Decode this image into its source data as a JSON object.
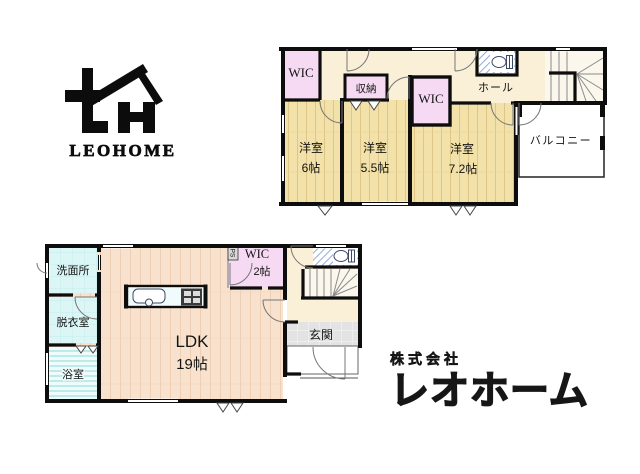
{
  "palette": {
    "wall": "#0d0d0d",
    "room_yellow": "#F2E1A8",
    "room_yellow_line": "#DEC687",
    "closet_pink": "#F6D9F2",
    "hall_cream": "#FAF0D8",
    "stair_white": "#FCF7ED",
    "ldk_peach": "#F8E2CE",
    "ldk_line": "#EDCFB6",
    "wet_cyan": "#DCF6F6",
    "bath_stripe": "#A8E2E2",
    "entrance_gray": "#E3E3E3",
    "hatch_blue": "#93A9DC"
  },
  "logo": {
    "wordmark": "LEOHOME"
  },
  "company": {
    "prefix": "株式会社",
    "name": "レオホーム"
  },
  "floor2": {
    "wic_left": "WIC",
    "closet": "収納",
    "wic_mid": "WIC",
    "hall": "ホール",
    "room6": {
      "name": "洋室",
      "size": "6帖"
    },
    "room55": {
      "name": "洋室",
      "size": "5.5帖"
    },
    "room72": {
      "name": "洋室",
      "size": "7.2帖"
    },
    "balcony": "バルコニー"
  },
  "floor1": {
    "washroom": "洗面所",
    "dressing": "脱衣室",
    "bath": "浴室",
    "ldk": {
      "name": "LDK",
      "size": "19帖"
    },
    "wic": {
      "name": "WIC",
      "size": "2帖"
    },
    "ps": "PS",
    "entrance": "玄関"
  }
}
